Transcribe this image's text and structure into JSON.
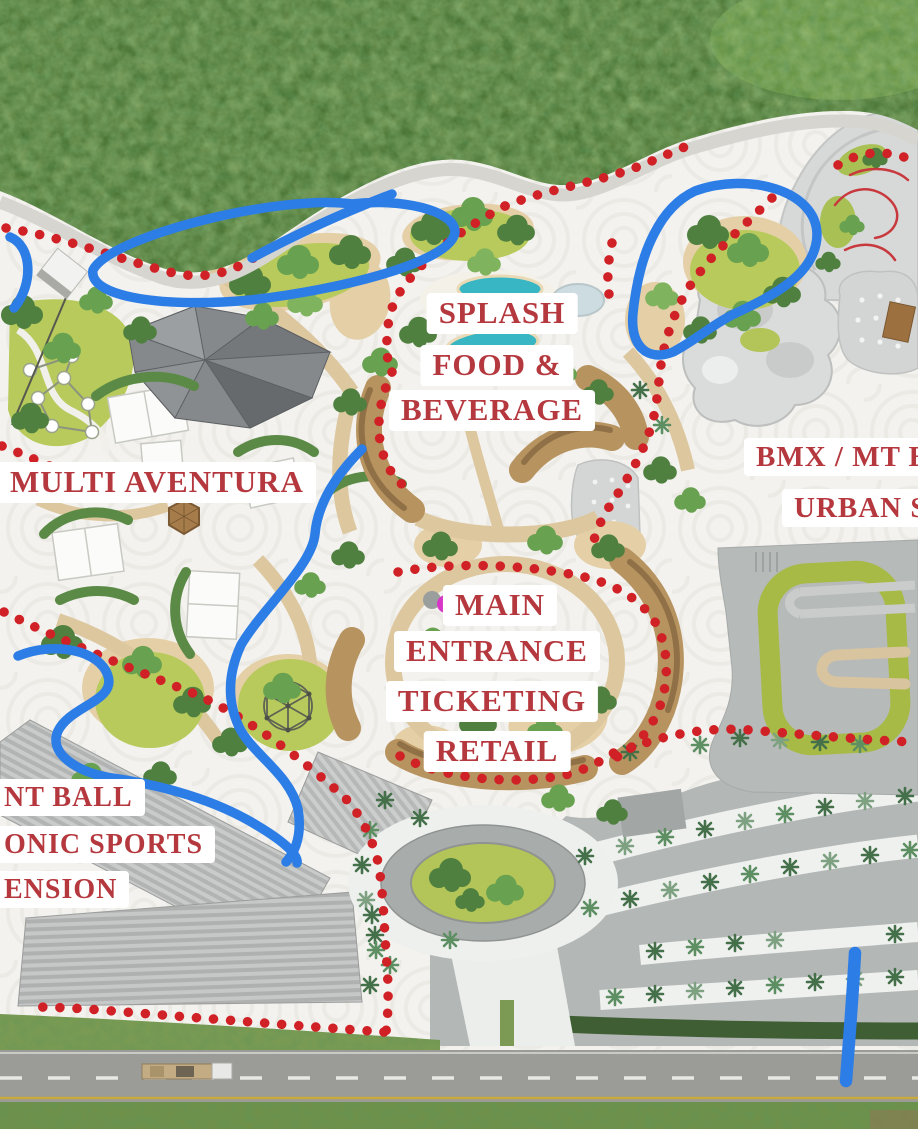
{
  "map": {
    "labels": {
      "splash_line1": "SPLASH",
      "splash_line2": "FOOD &",
      "splash_line3": "BEVERAGE",
      "multi_aventura": "MULTI AVENTURA",
      "entrance_line1": "MAIN",
      "entrance_line2": "ENTRANCE",
      "entrance_line3": "TICKETING",
      "entrance_line4": "RETAIL",
      "bmx_line1": "BMX / MT BIK",
      "bmx_line2": "URBAN S",
      "paintball_line1": "NT BALL",
      "paintball_line2": "ONIC SPORTS",
      "paintball_line3": "ENSION"
    },
    "colors": {
      "label_text": "#b5383e",
      "label_bg": "#ffffff",
      "trail_dots": "#d02127",
      "annotation_blue": "#2d7de6",
      "marker_magenta": "#d836c8"
    }
  }
}
